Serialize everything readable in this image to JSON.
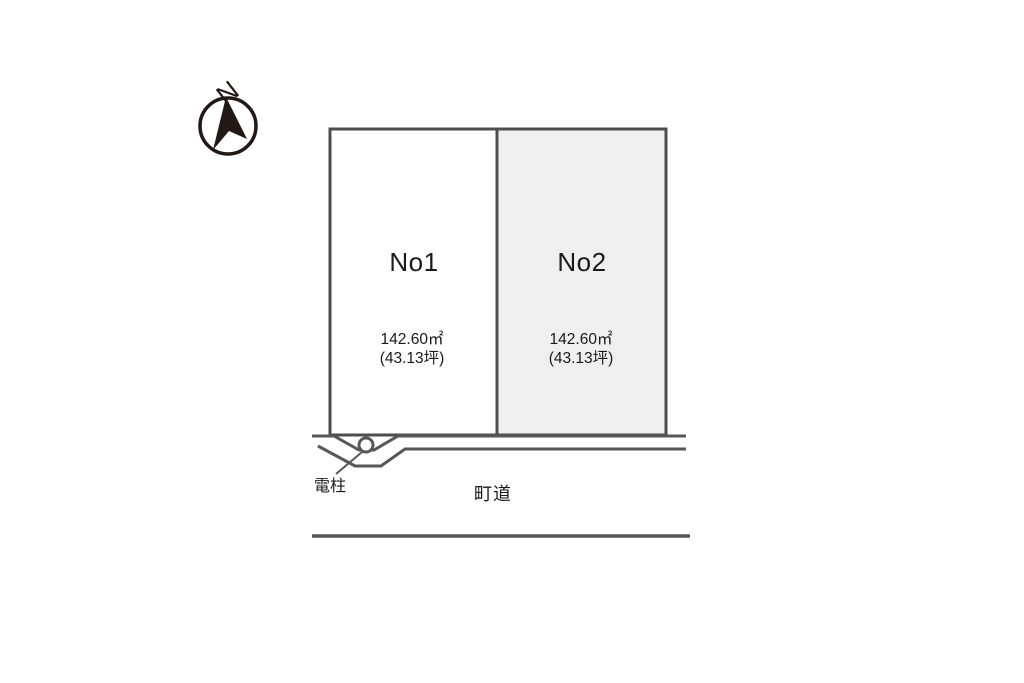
{
  "page": {
    "background": "#ffffff",
    "width": 1024,
    "height": 683
  },
  "compass": {
    "north_label": "N"
  },
  "lots": [
    {
      "label": "No1",
      "area_sqm": "142.60㎡",
      "area_tsubo": "(43.13坪)",
      "fill": "#ffffff"
    },
    {
      "label": "No2",
      "area_sqm": "142.60㎡",
      "area_tsubo": "(43.13坪)",
      "fill": "#efefef"
    }
  ],
  "labels": {
    "utility_pole": "電柱",
    "road": "町道"
  },
  "colors": {
    "lot_border": "#4d4d4d",
    "road_line": "#575757",
    "compass_ink": "#231815",
    "text": "#1a1a1a"
  }
}
